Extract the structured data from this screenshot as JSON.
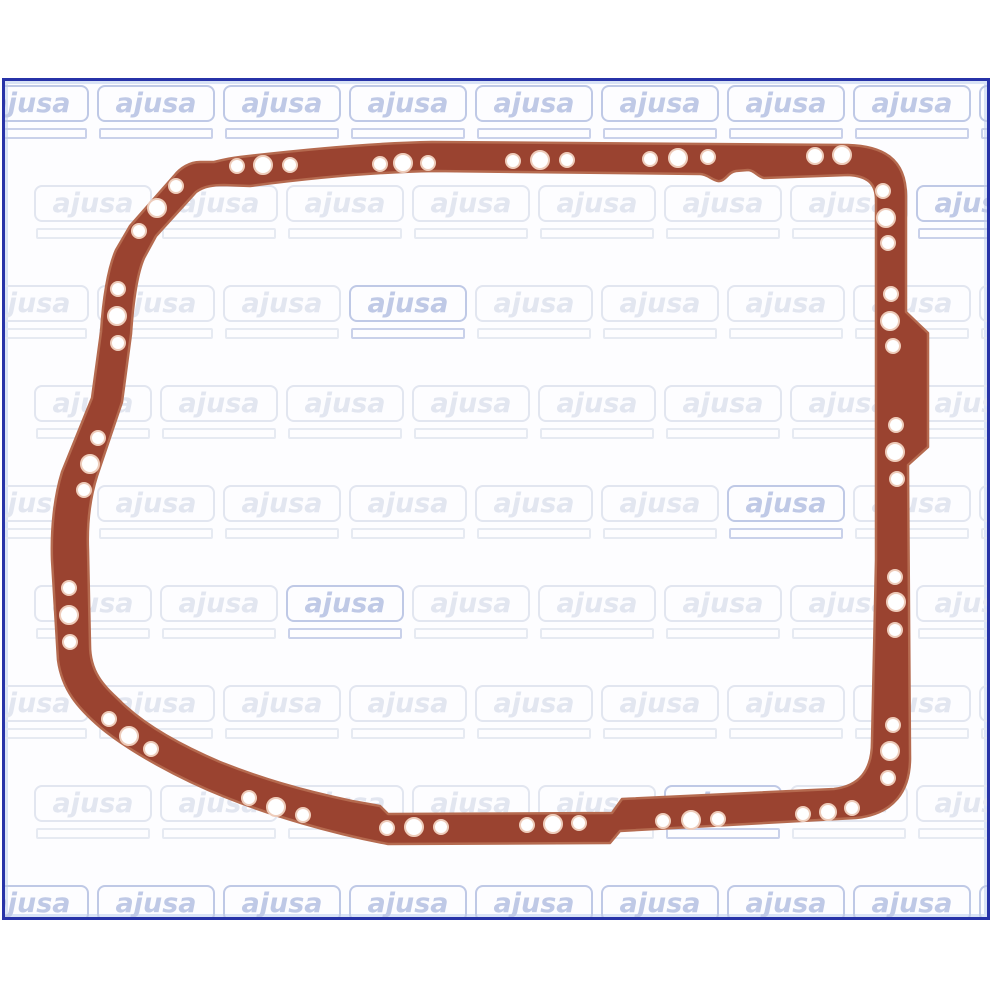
{
  "photo": {
    "alt": "Oil pan gasket product photo on ajusa watermark background",
    "brand_watermark": "ajusa"
  },
  "colors": {
    "page_bg": "#ffffff",
    "content_bg": "#fdfdff",
    "frame_border": "#2733a8",
    "frame_inner_glow": "#d9e3f6",
    "watermark_faint": "#e2e6f0",
    "watermark_strong": "#bfc9e6",
    "gasket_fill": "#9a4330",
    "gasket_edge": "#b56a4f",
    "hole_fill": "#ffffff",
    "hole_rim": "#eeccba"
  },
  "watermark_grid": {
    "rows": 9,
    "cols": 9,
    "row_pitch": 100,
    "col_pitch": 126,
    "alt_row_offset": 63,
    "origin_x": -34,
    "origin_y": 4
  },
  "gasket": {
    "outer_path": "M240 157 C300 150 370 143 432 142 L848 145 C882 146 906 158 906 196 L906 312 L928 333 L928 447 L908 465 L910 755 C911 792 893 814 856 818 L620 831 L610 843 L388 844 C330 833 270 815 225 797 C180 779 130 752 100 727 C78 708 62 690 58 660 L52 560 C51 530 54 498 62 472 L92 398 L101 332 C103 300 108 268 116 250 L130 226 L174 176 C180 168 190 162 200 162 L214 162 C222 160 230 158 240 157 Z",
    "inner_path": "M250 186 C310 178 375 172 435 171 L700 174 C707 174 712 180 718 181 C725 182 728 172 736 171 L748 170 C754 170 758 177 764 178 L848 175 C868 176 876 184 876 200 L876 560 L872 742 C872 772 858 786 834 789 L622 799 L612 813 L388 814 L380 806 L352 801 C300 790 260 778 220 762 C180 745 145 725 122 703 C108 689 90 676 90 645 L88 550 C87 524 90 498 97 476 L122 402 L131 334 C133 304 137 274 144 258 L156 236 L196 192 C204 186 214 185 224 185 Z",
    "holes": [
      [
        237,
        166,
        7
      ],
      [
        263,
        165,
        9
      ],
      [
        290,
        165,
        7
      ],
      [
        380,
        164,
        7
      ],
      [
        403,
        163,
        9
      ],
      [
        428,
        163,
        7
      ],
      [
        513,
        161,
        7
      ],
      [
        540,
        160,
        9
      ],
      [
        567,
        160,
        7
      ],
      [
        650,
        159,
        7
      ],
      [
        678,
        158,
        9
      ],
      [
        708,
        157,
        7
      ],
      [
        815,
        156,
        8
      ],
      [
        842,
        155,
        9
      ],
      [
        176,
        186,
        7
      ],
      [
        157,
        208,
        9
      ],
      [
        139,
        231,
        7
      ],
      [
        118,
        289,
        7
      ],
      [
        117,
        316,
        9
      ],
      [
        118,
        343,
        7
      ],
      [
        98,
        438,
        7
      ],
      [
        90,
        464,
        9
      ],
      [
        84,
        490,
        7
      ],
      [
        69,
        588,
        7
      ],
      [
        69,
        615,
        9
      ],
      [
        70,
        642,
        7
      ],
      [
        109,
        719,
        7
      ],
      [
        129,
        736,
        9
      ],
      [
        151,
        749,
        7
      ],
      [
        249,
        798,
        7
      ],
      [
        276,
        807,
        9
      ],
      [
        303,
        815,
        7
      ],
      [
        387,
        828,
        7
      ],
      [
        414,
        827,
        9
      ],
      [
        441,
        827,
        7
      ],
      [
        527,
        825,
        7
      ],
      [
        553,
        824,
        9
      ],
      [
        579,
        823,
        7
      ],
      [
        663,
        821,
        7
      ],
      [
        691,
        820,
        9
      ],
      [
        718,
        819,
        7
      ],
      [
        803,
        814,
        7
      ],
      [
        828,
        812,
        8
      ],
      [
        852,
        808,
        7
      ],
      [
        888,
        778,
        7
      ],
      [
        890,
        751,
        9
      ],
      [
        893,
        725,
        7
      ],
      [
        895,
        630,
        7
      ],
      [
        896,
        602,
        9
      ],
      [
        895,
        577,
        7
      ],
      [
        897,
        479,
        7
      ],
      [
        895,
        452,
        9
      ],
      [
        896,
        425,
        7
      ],
      [
        893,
        346,
        7
      ],
      [
        890,
        321,
        9
      ],
      [
        891,
        294,
        7
      ],
      [
        888,
        243,
        7
      ],
      [
        886,
        218,
        9
      ],
      [
        883,
        191,
        7
      ]
    ]
  }
}
